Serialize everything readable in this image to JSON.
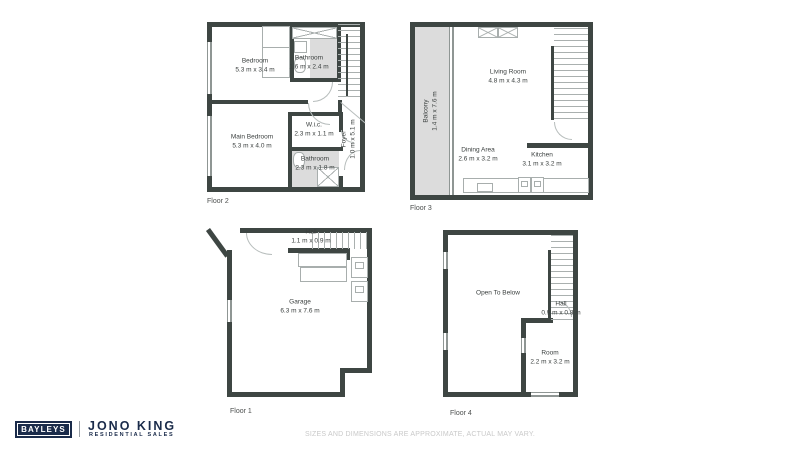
{
  "colors": {
    "wall": "#3e4643",
    "shaded_area": "#dcdcdc",
    "fixture_line": "#a8aead",
    "label_text": "#3a3f3e",
    "brand_navy": "#1a2b4a",
    "disclaimer_text": "#c9c9c9"
  },
  "floors": {
    "floor2": {
      "label": "Floor 2",
      "rooms": {
        "bedroom": {
          "name": "Bedroom",
          "dims": "5.3 m x 3.4 m"
        },
        "bathroom_top": {
          "name": "Bathroom",
          "dims": "1.6 m x 2.4 m"
        },
        "main_bedroom": {
          "name": "Main Bedroom",
          "dims": "5.3 m x 4.0 m"
        },
        "wic": {
          "name": "W.i.c.",
          "dims": "2.3 m x 1.1 m"
        },
        "bathroom_bottom": {
          "name": "Bathroom",
          "dims": "2.3 m x 1.8 m"
        },
        "foyer": {
          "name": "Foyer",
          "dims": "1.0 m x 5.1 m"
        }
      }
    },
    "floor3": {
      "label": "Floor 3",
      "rooms": {
        "balcony": {
          "name": "Balcony",
          "dims": "1.4 m x 7.6 m"
        },
        "living_room": {
          "name": "Living Room",
          "dims": "4.8 m x 4.3 m"
        },
        "dining_area": {
          "name": "Dining Area",
          "dims": "2.6 m x 3.2 m"
        },
        "kitchen": {
          "name": "Kitchen",
          "dims": "3.1 m x 3.2 m"
        }
      }
    },
    "floor1": {
      "label": "Floor 1",
      "rooms": {
        "hall": {
          "name": "Hall",
          "dims": "1.1 m x 0.9 m"
        },
        "garage": {
          "name": "Garage",
          "dims": "6.3 m x 7.6 m"
        }
      }
    },
    "floor4": {
      "label": "Floor 4",
      "rooms": {
        "open_to_below": {
          "name": "Open To Below"
        },
        "hall": {
          "name": "Hall",
          "dims": "0.9 m x 0.8 m"
        },
        "room": {
          "name": "Room",
          "dims": "2.2 m x 3.2 m"
        }
      }
    }
  },
  "branding": {
    "bayleys_logo": "BAYLEYS",
    "agent_name": "JONO KING",
    "agent_tagline": "RESIDENTIAL SALES"
  },
  "disclaimer": "SIZES AND DIMENSIONS ARE APPROXIMATE, ACTUAL MAY VARY."
}
